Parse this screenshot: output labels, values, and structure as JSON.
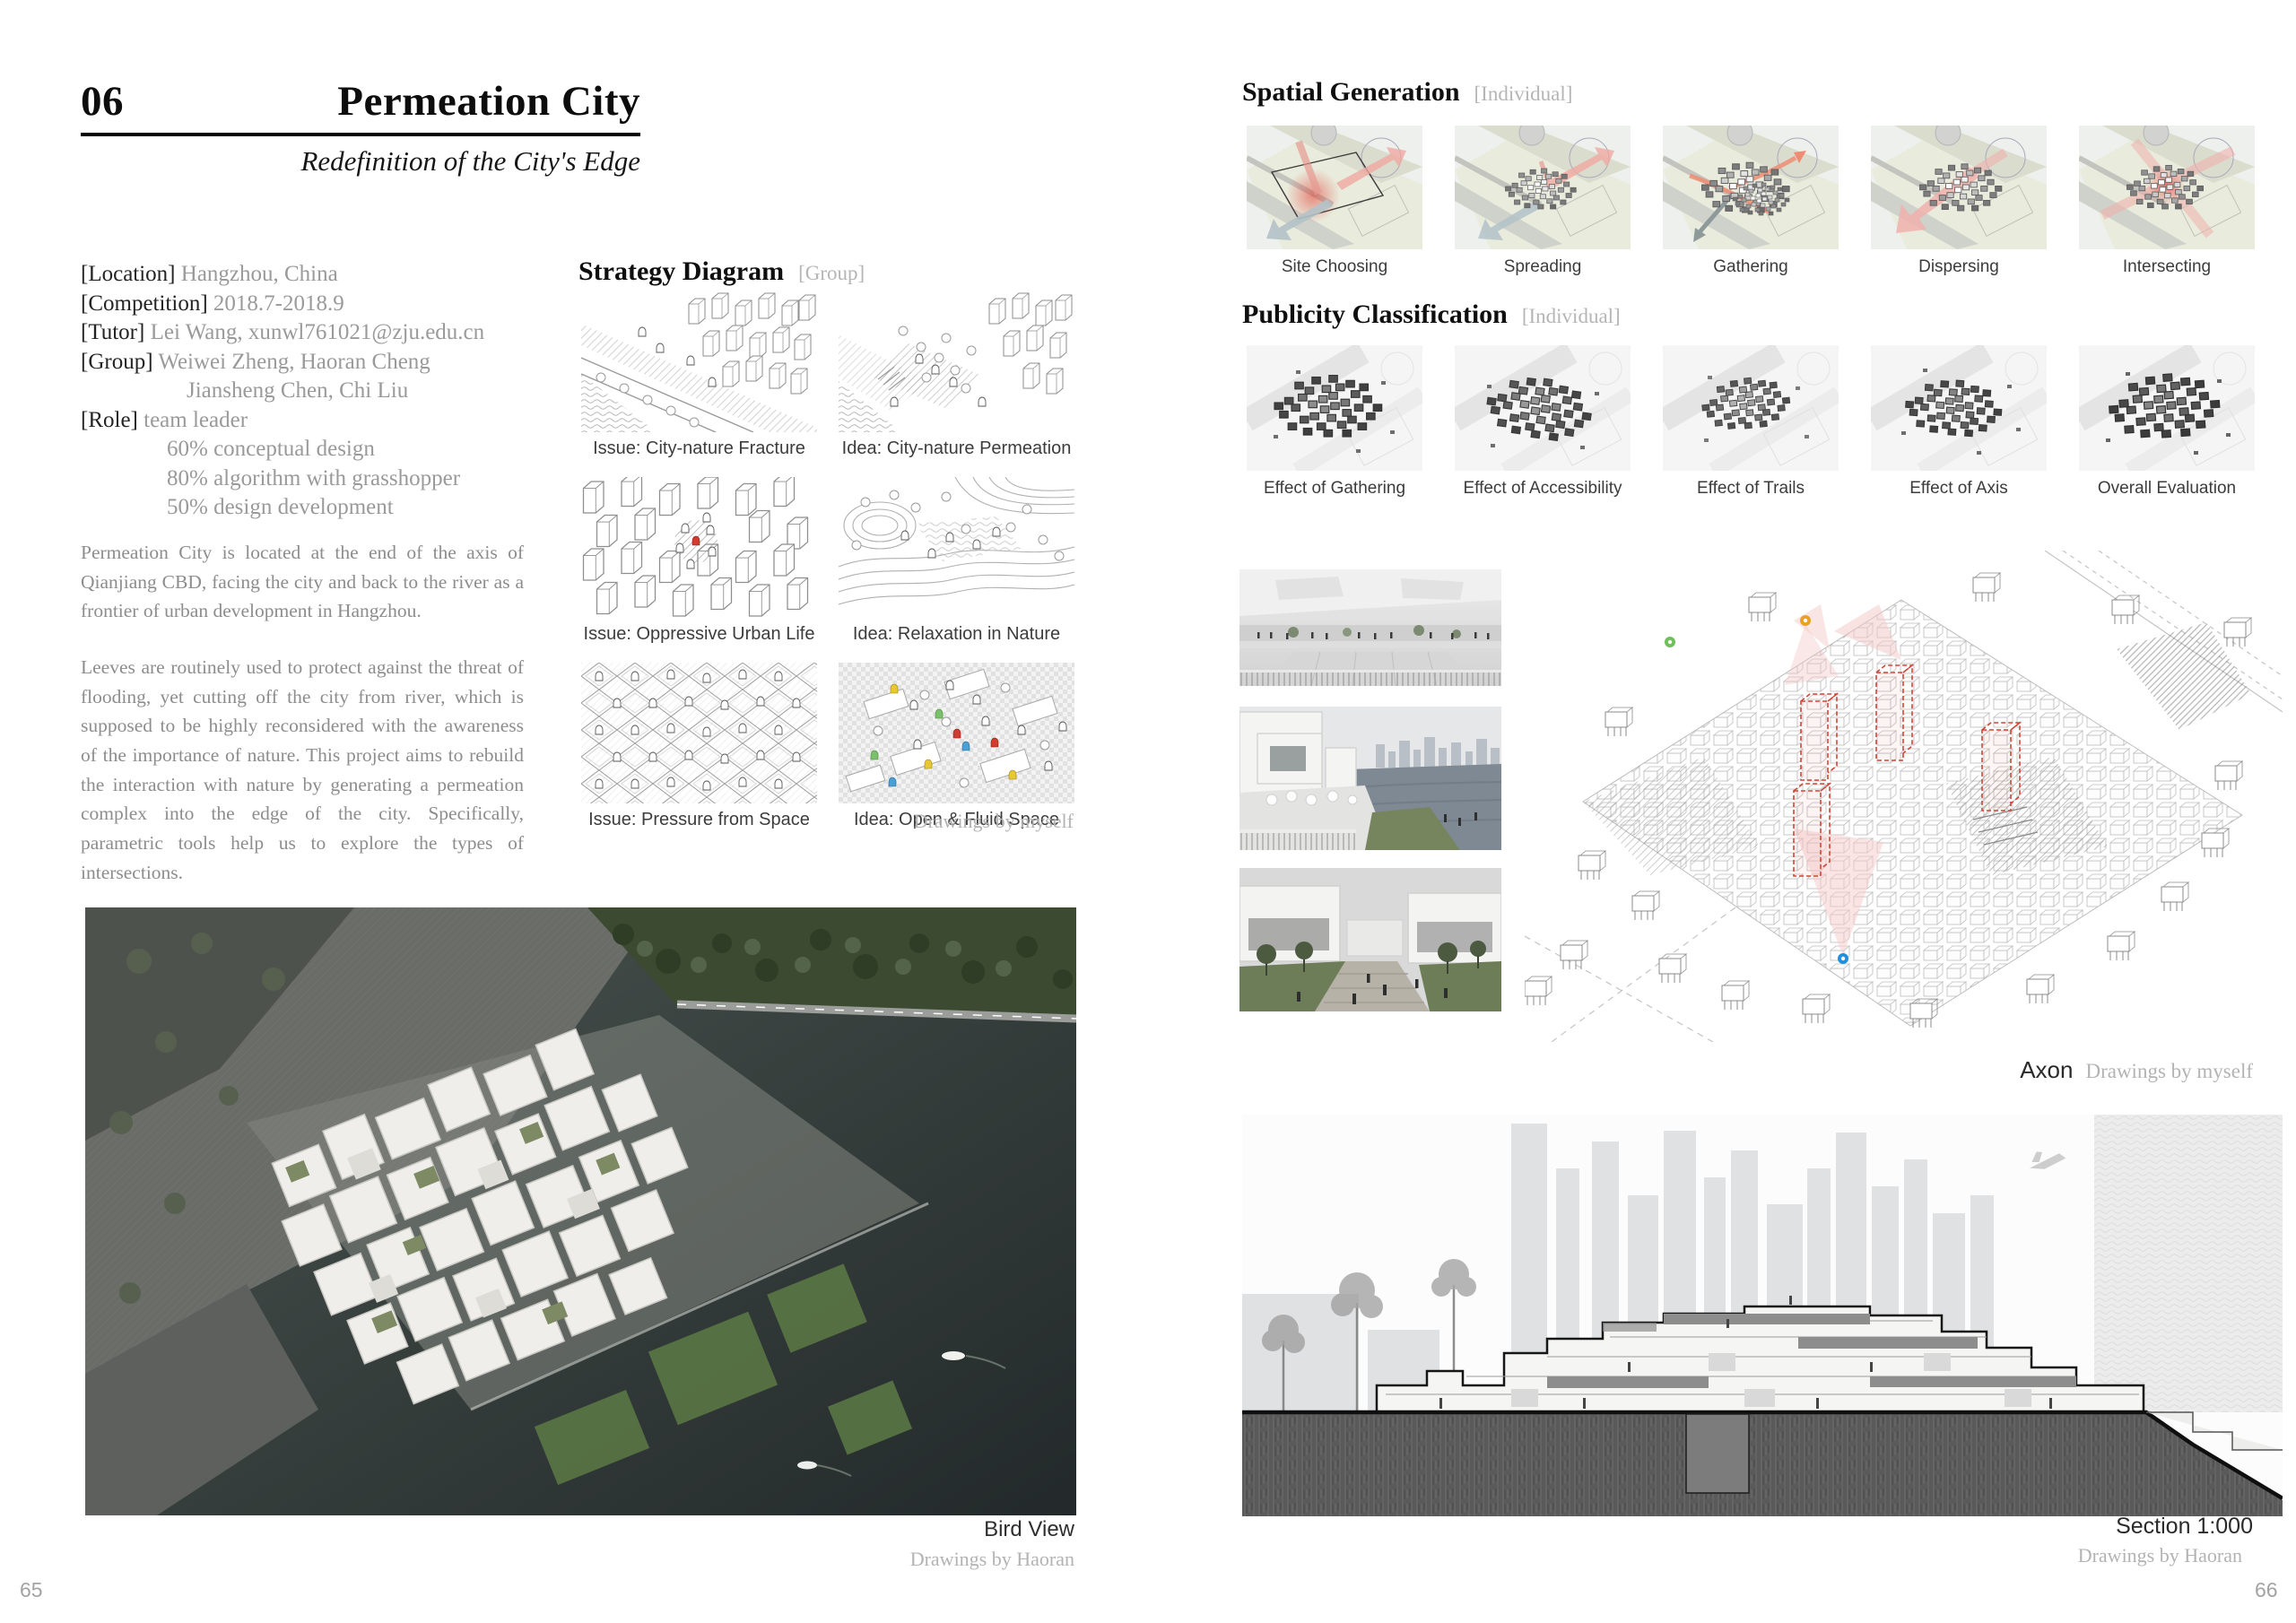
{
  "left": {
    "number": "06",
    "title": "Permeation City",
    "subtitle": "Redefinition of the City's Edge",
    "info": [
      {
        "label": "[Location]",
        "value": "Hangzhou, China"
      },
      {
        "label": "[Competition]",
        "value": "2018.7-2018.9"
      },
      {
        "label": "[Tutor]",
        "value": "Lei Wang, xunwl761021@zju.edu.cn"
      },
      {
        "label": "[Group]",
        "value": "Weiwei Zheng, Haoran Cheng"
      },
      {
        "label": "",
        "value": "Jiansheng Chen, Chi Liu"
      },
      {
        "label": "[Role]",
        "value": "team leader"
      },
      {
        "label": "",
        "value": "60% conceptual design"
      },
      {
        "label": "",
        "value": "80% algorithm with grasshopper"
      },
      {
        "label": "",
        "value": "50% design development"
      }
    ],
    "paragraphs": [
      "Permeation City is located at the end of the axis of Qianjiang CBD, facing the city and back to the river as a frontier of urban development in Hangzhou.",
      "Leeves are routinely used to protect against the threat of flooding, yet cutting off the city from river, which is supposed to be highly reconsidered with the awareness of the importance of nature. This project aims to rebuild the interaction with nature by generating a permeation complex into the edge of the city. Specifically, parametric tools help us to explore the types of intersections."
    ],
    "strategy": {
      "heading": "Strategy Diagram",
      "tag": "[Group]",
      "cards": [
        {
          "caption": "Issue: City-nature Fracture"
        },
        {
          "caption": "Idea: City-nature Permeation"
        },
        {
          "caption": "Issue: Oppressive Urban Life"
        },
        {
          "caption": "Idea: Relaxation in Nature"
        },
        {
          "caption": "Issue: Pressure from Space"
        },
        {
          "caption": "Idea: Open & Fluid Space"
        }
      ],
      "credit": "Drawings by myself"
    },
    "birdview": {
      "caption": "Bird View",
      "credit": "Drawings by Haoran"
    },
    "page_number": "65"
  },
  "right": {
    "spatial": {
      "heading": "Spatial Generation",
      "tag": "[Individual]",
      "items": [
        "Site Choosing",
        "Spreading",
        "Gathering",
        "Dispersing",
        "Intersecting"
      ]
    },
    "publicity": {
      "heading": "Publicity Classification",
      "tag": "[Individual]",
      "items": [
        "Effect of Gathering",
        "Effect of Accessibility",
        "Effect of Trails",
        "Effect of Axis",
        "Overall Evaluation"
      ]
    },
    "axon": {
      "label": "Axon",
      "credit": "Drawings by myself"
    },
    "section": {
      "label": "Section 1:000",
      "credit": "Drawings by Haoran"
    },
    "page_number": "66"
  },
  "colors": {
    "accent_red": "#d23b2f",
    "soft_pink": "#f0b2ad",
    "plan_beige": "#e9ebdc",
    "water_dark": "#2f3736",
    "text_gray": "#8d8d8d"
  }
}
